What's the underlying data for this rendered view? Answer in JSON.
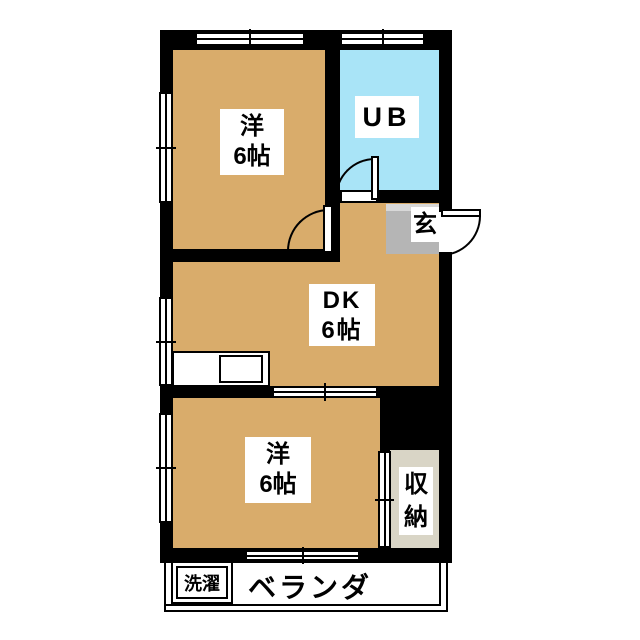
{
  "rooms": {
    "western_top": {
      "name": "洋",
      "size": "6帖"
    },
    "unit_bath": {
      "name": "UB"
    },
    "genkan": {
      "name": "玄"
    },
    "dk": {
      "name": "DK",
      "size": "6帖"
    },
    "western_bottom": {
      "name": "洋",
      "size": "6帖"
    },
    "storage": {
      "char1": "収",
      "char2": "納"
    },
    "laundry": {
      "name": "洗濯"
    },
    "veranda": {
      "name": "ベランダ"
    }
  },
  "colors": {
    "room_tan": "#D9AC6B",
    "bath_blue": "#A9E4F7",
    "genkan_gray": "#B5B5B5",
    "genkan_step": "#D8D8D8",
    "storage_beige": "#D9D5C6",
    "wall_black": "#000000",
    "paper_white": "#FFFFFF"
  }
}
